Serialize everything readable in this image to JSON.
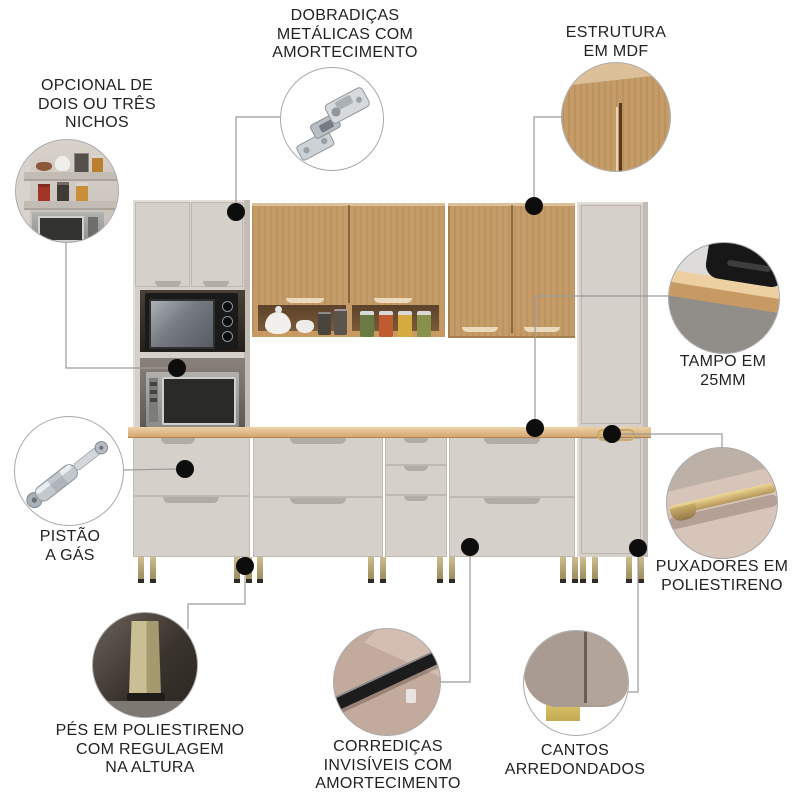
{
  "callouts": {
    "nichos": {
      "label": "OPCIONAL DE\nDOIS OU TRÊS\nNICHOS",
      "photo": "shelf-niches-with-jars-and-microwave"
    },
    "dobradicas": {
      "label": "DOBRADIÇAS\nMETÁLICAS COM\nAMORTECIMENTO",
      "photo": "soft-close-metal-hinge"
    },
    "estrutura": {
      "label": "ESTRUTURA\nEM MDF",
      "photo": "mdf-wood-door-closeup"
    },
    "tampo": {
      "label": "TAMPO EM\n25MM",
      "photo": "25mm-countertop-edge"
    },
    "pistao": {
      "label": "PISTÃO\nA GÁS",
      "photo": "gas-piston-strut"
    },
    "puxadores": {
      "label": "PUXADORES EM\nPOLIESTIRENO",
      "photo": "gold-polystyrene-handle"
    },
    "pes": {
      "label": "PÉS EM POLIESTIRENO\nCOM REGULAGEM\nNA ALTURA",
      "photo": "adjustable-polystyrene-foot"
    },
    "corredicas": {
      "label": "CORREDIÇAS\nINVISÍVEIS COM\nAMORTECIMENTO",
      "photo": "concealed-drawer-slide"
    },
    "cantos": {
      "label": "CANTOS\nARREDONDADOS",
      "photo": "rounded-cabinet-corner"
    }
  },
  "colors": {
    "background": "#ffffff",
    "label_text": "#222222",
    "leader_line": "#9a9a9a",
    "callout_dot": "#0d0d0d",
    "cabinet_greige": "#d6d0ca",
    "cabinet_greige_shade": "#c2bcb5",
    "cabinet_greige_dark": "#a9a39d",
    "wood_mdf": "#c59c68",
    "wood_light": "#dcc09a",
    "wood_seam": "#5a3a20",
    "countertop": "#dfb988",
    "gold_accent": "#b9a86f",
    "appliance_black": "#1a1a1a",
    "appliance_gray": "#a0a0a0",
    "niche_dark": "#3a332c",
    "photo_taupe": "#c2aa9c"
  }
}
